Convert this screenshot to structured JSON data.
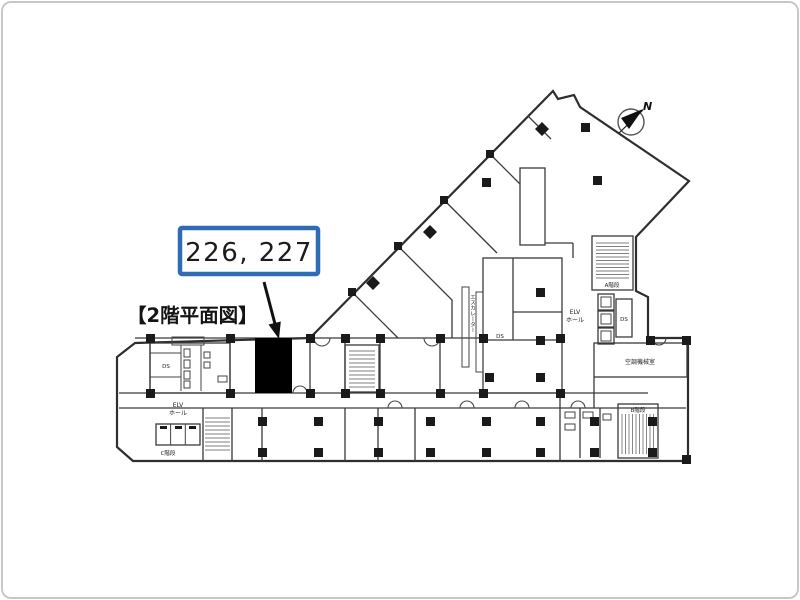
{
  "page": {
    "background": "#ffffff",
    "frame_border_color": "#c8c8c8",
    "line_color": "#2e2e2e"
  },
  "title": {
    "text": "【2階平面図】"
  },
  "callout": {
    "label": "226, 227",
    "border_color": "#2e6db4",
    "fill": "#ffffff"
  },
  "highlight_unit": {
    "fill": "#000000"
  },
  "compass": {
    "label": "N"
  },
  "labels": {
    "escalator": "エスカレーター",
    "elv_hall_left_line1": "ELV",
    "elv_hall_left_line2": "ホール",
    "elv_hall_right_line1": "ELV",
    "elv_hall_right_line2": "ホール",
    "ds_left": "DS",
    "ds_center": "DS",
    "ds_right": "DS",
    "stairs_a": "A階段",
    "stairs_b": "B階段",
    "stairs_c": "C階段",
    "machine_room": "空調機械室"
  }
}
